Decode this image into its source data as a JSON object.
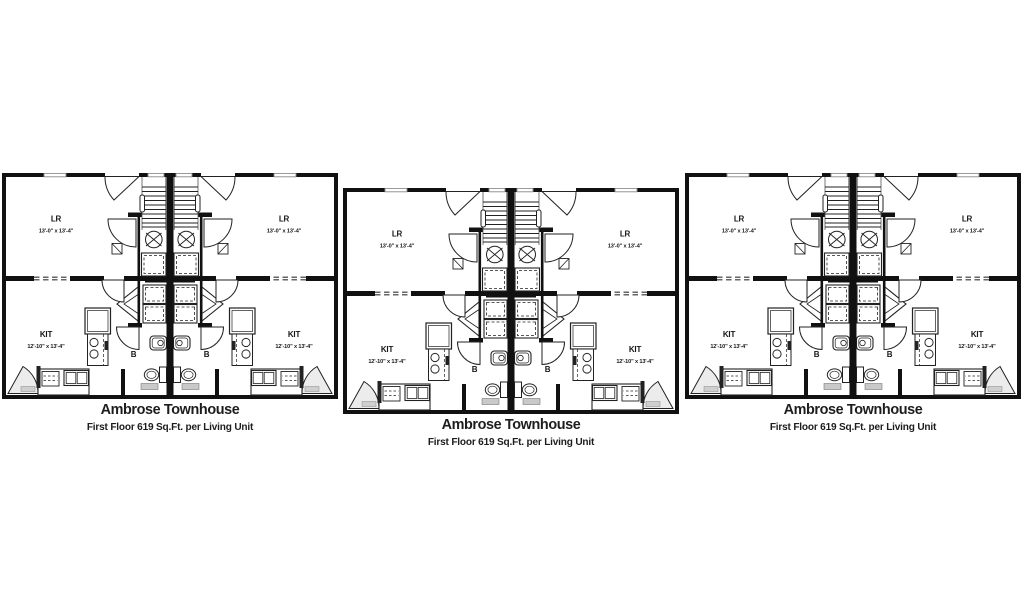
{
  "figure": {
    "background_color": "#ffffff",
    "line_color": "#1a1a1a",
    "plans": [
      {
        "title": "Ambrose Townhouse",
        "subtitle": "First Floor 619 Sq.Ft. per Living Unit"
      },
      {
        "title": "Ambrose Townhouse",
        "subtitle": "First Floor 619 Sq.Ft. per Living Unit"
      },
      {
        "title": "Ambrose Townhouse",
        "subtitle": "First Floor 619 Sq.Ft. per Living Unit"
      }
    ],
    "room_labels": {
      "living_room": "LR",
      "living_room_dimensions": "13'-0\" x 13'-4\"",
      "kitchen": "KIT",
      "kitchen_dimensions": "12'-10\" x 13'-4\"",
      "bath": "B"
    }
  }
}
